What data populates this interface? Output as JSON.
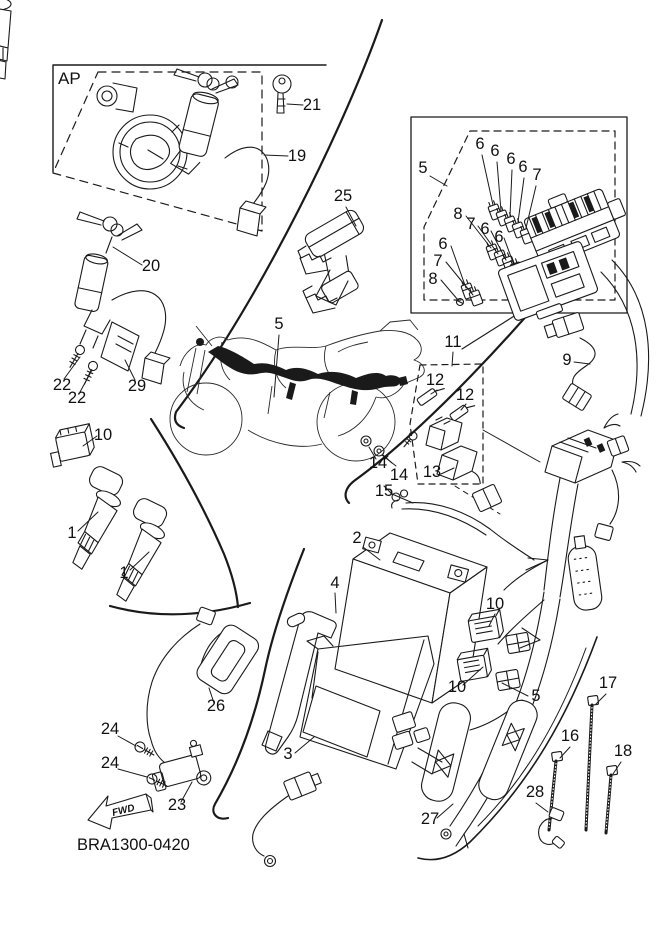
{
  "diagram": {
    "code": "BRA1300-0420",
    "region_tag": "AP",
    "fwd_marker": "FWD",
    "callouts": [
      {
        "part": "key",
        "text": "21"
      },
      {
        "part": "lock-set",
        "text": "19"
      },
      {
        "part": "main-switch",
        "text": "20"
      },
      {
        "part": "screw",
        "text": "22"
      },
      {
        "part": "screw",
        "text": "22"
      },
      {
        "part": "bracket-plate",
        "text": "29"
      },
      {
        "part": "relay-assembly",
        "text": "25"
      },
      {
        "part": "fuse-box-group",
        "text": "5"
      },
      {
        "part": "fuse",
        "text": "6"
      },
      {
        "part": "fuse",
        "text": "6"
      },
      {
        "part": "fuse",
        "text": "6"
      },
      {
        "part": "fuse",
        "text": "6"
      },
      {
        "part": "fuse",
        "text": "7"
      },
      {
        "part": "fuse",
        "text": "8"
      },
      {
        "part": "fuse",
        "text": "7"
      },
      {
        "part": "fuse",
        "text": "6"
      },
      {
        "part": "fuse",
        "text": "6"
      },
      {
        "part": "fuse",
        "text": "6"
      },
      {
        "part": "fuse",
        "text": "7"
      },
      {
        "part": "fuse",
        "text": "8"
      },
      {
        "part": "wire-harness",
        "text": "5"
      },
      {
        "part": "relay-group",
        "text": "11"
      },
      {
        "part": "terminal",
        "text": "12"
      },
      {
        "part": "terminal",
        "text": "12"
      },
      {
        "part": "sensor-lead",
        "text": "9"
      },
      {
        "part": "relay",
        "text": "13"
      },
      {
        "part": "washer-bolt",
        "text": "14"
      },
      {
        "part": "washer-bolt",
        "text": "14"
      },
      {
        "part": "battery-lead",
        "text": "15"
      },
      {
        "part": "relay-unit",
        "text": "10"
      },
      {
        "part": "ignition-coil",
        "text": "1"
      },
      {
        "part": "ignition-coil",
        "text": "1"
      },
      {
        "part": "battery",
        "text": "2"
      },
      {
        "part": "battery-band",
        "text": "4"
      },
      {
        "part": "relay-unit",
        "text": "10"
      },
      {
        "part": "relay-unit",
        "text": "10"
      },
      {
        "part": "wire-harness",
        "text": "5"
      },
      {
        "part": "battery-box",
        "text": "3"
      },
      {
        "part": "boot-cover",
        "text": "26"
      },
      {
        "part": "screw",
        "text": "24"
      },
      {
        "part": "screw",
        "text": "24"
      },
      {
        "part": "switch",
        "text": "23"
      },
      {
        "part": "harness-guard",
        "text": "27"
      },
      {
        "part": "cable-tie",
        "text": "16"
      },
      {
        "part": "cable-tie",
        "text": "17"
      },
      {
        "part": "cable-tie",
        "text": "18"
      },
      {
        "part": "clamp",
        "text": "28"
      }
    ]
  }
}
